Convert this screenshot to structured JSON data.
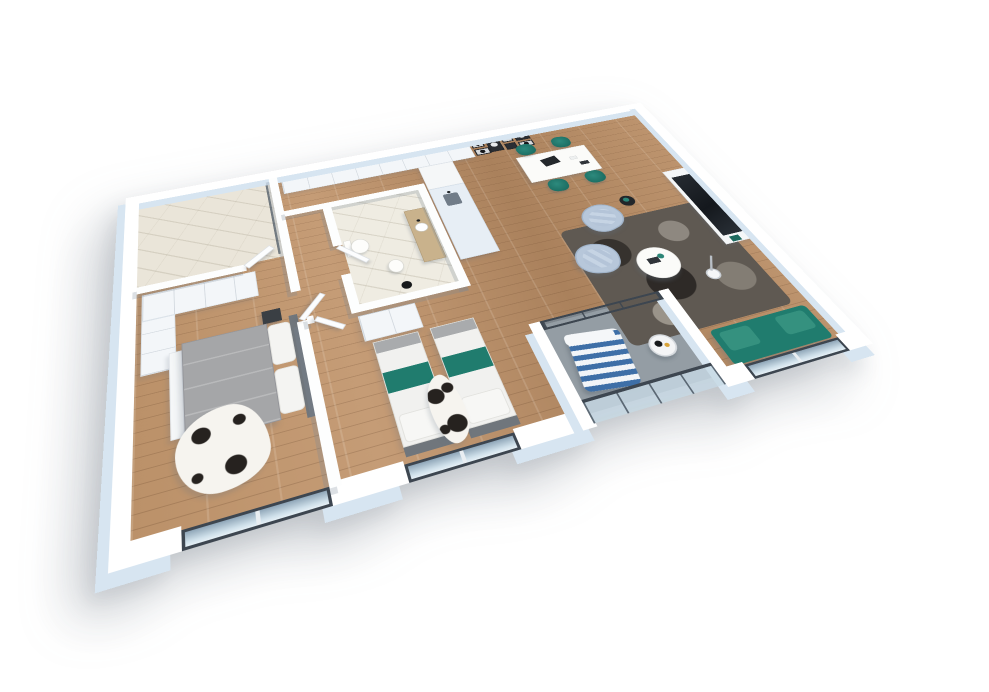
{
  "scene": {
    "title": "3D apartment floor plan render",
    "style": "isometric 3D architectural visualization on white background",
    "view": "top-down perspective, plan rotated about -18 degrees and tilted",
    "background": "#ffffff"
  },
  "palette": {
    "wall_top": "#ffffff",
    "wall_side": "#d7e5f1",
    "wood_floor": "#b68c66",
    "marble_floor": "#eae5d9",
    "balcony_floor": "#949da4",
    "glass": "#c3d6e3",
    "frame_dark": "#3d4650",
    "accent_teal": "#207c6e",
    "armchair_blue": "#b7c7da",
    "rug_dark": "#5f5952",
    "bed_gray": "#a5a6a8",
    "headboard_gray": "#70767c",
    "pillow_white": "#f4f4f2",
    "cowhide_white": "#f6f4ef",
    "cowhide_spot": "#26221f",
    "cabinet_white": "#f3f6f9",
    "counter_blue": "#e7eef5",
    "shadow": "rgba(98,110,124,0.30)"
  },
  "rooms": [
    {
      "id": "bathroom-main",
      "label": "Bathroom with marble floor and glass shower screen",
      "floor": "marble"
    },
    {
      "id": "hallway",
      "label": "Hallway and entry with built-in wardrobes",
      "floor": "wood"
    },
    {
      "id": "kitchen-dining",
      "label": "Kitchen and dining area",
      "floor": "wood"
    },
    {
      "id": "living-room",
      "label": "Living room",
      "floor": "wood"
    },
    {
      "id": "bedroom-master",
      "label": "Master bedroom with double bed",
      "floor": "wood"
    },
    {
      "id": "bedroom-second",
      "label": "Second bedroom with two single beds",
      "floor": "wood"
    },
    {
      "id": "bathroom-wc",
      "label": "WC / shower room with toilet and washbasin",
      "floor": "marble"
    },
    {
      "id": "balcony",
      "label": "Recessed balcony with glass railing",
      "floor": "concrete"
    }
  ],
  "furniture": {
    "double_bed": "Double bed with grey duvet, white pillows and dark headboard",
    "single_beds": "Two single beds with teal runners and grey throws",
    "wardrobes_master": "White built-in wardrobes, master bedroom",
    "wardrobe_second": "White wardrobe, second bedroom",
    "nightstand": "Dark nightstand",
    "cowhide_rug_master": "Cowhide rug, master bedroom",
    "cowhide_rug_second": "Cowhide rug between single beds",
    "hall_cabinets": "White cabinet row along north wall",
    "gallery_wall": "Gallery wall of framed monochrome art",
    "kitchen_tall_unit": "Tall kitchen unit",
    "kitchen_counter": "Kitchen counter with sink",
    "dining_table": "White dining table with laptop",
    "dining_chairs": "Four teal dining chairs",
    "tv": "Wall-mounted TV",
    "tv_console": "White media console",
    "armchairs": "Two light-blue quilted armchairs",
    "side_table": "Small dark side table with plant",
    "coffee_table": "Round white coffee table",
    "rug_living": "Dark mottled area rug",
    "arc_lamp": "White arc floor lamp",
    "sofa": "Teal two-seat sofa by the window",
    "toilet": "Toilet",
    "bidet": "Bidet",
    "washbasin": "Wood washbasin counter with round sink",
    "bath_lamp": "Black bathroom lamp",
    "shower_screen": "Glass shower screen",
    "lounge_chair": "Blue and white striped balcony lounger",
    "balcony_table": "Round balcony side table"
  },
  "windows": [
    {
      "id": "window-master",
      "location": "south wall, master bedroom"
    },
    {
      "id": "window-second",
      "location": "south wall, second bedroom"
    },
    {
      "id": "balcony-railing",
      "location": "south edge of balcony"
    },
    {
      "id": "window-living",
      "location": "south wall, living room"
    },
    {
      "id": "balcony-door",
      "location": "glass door between living area and balcony"
    }
  ]
}
